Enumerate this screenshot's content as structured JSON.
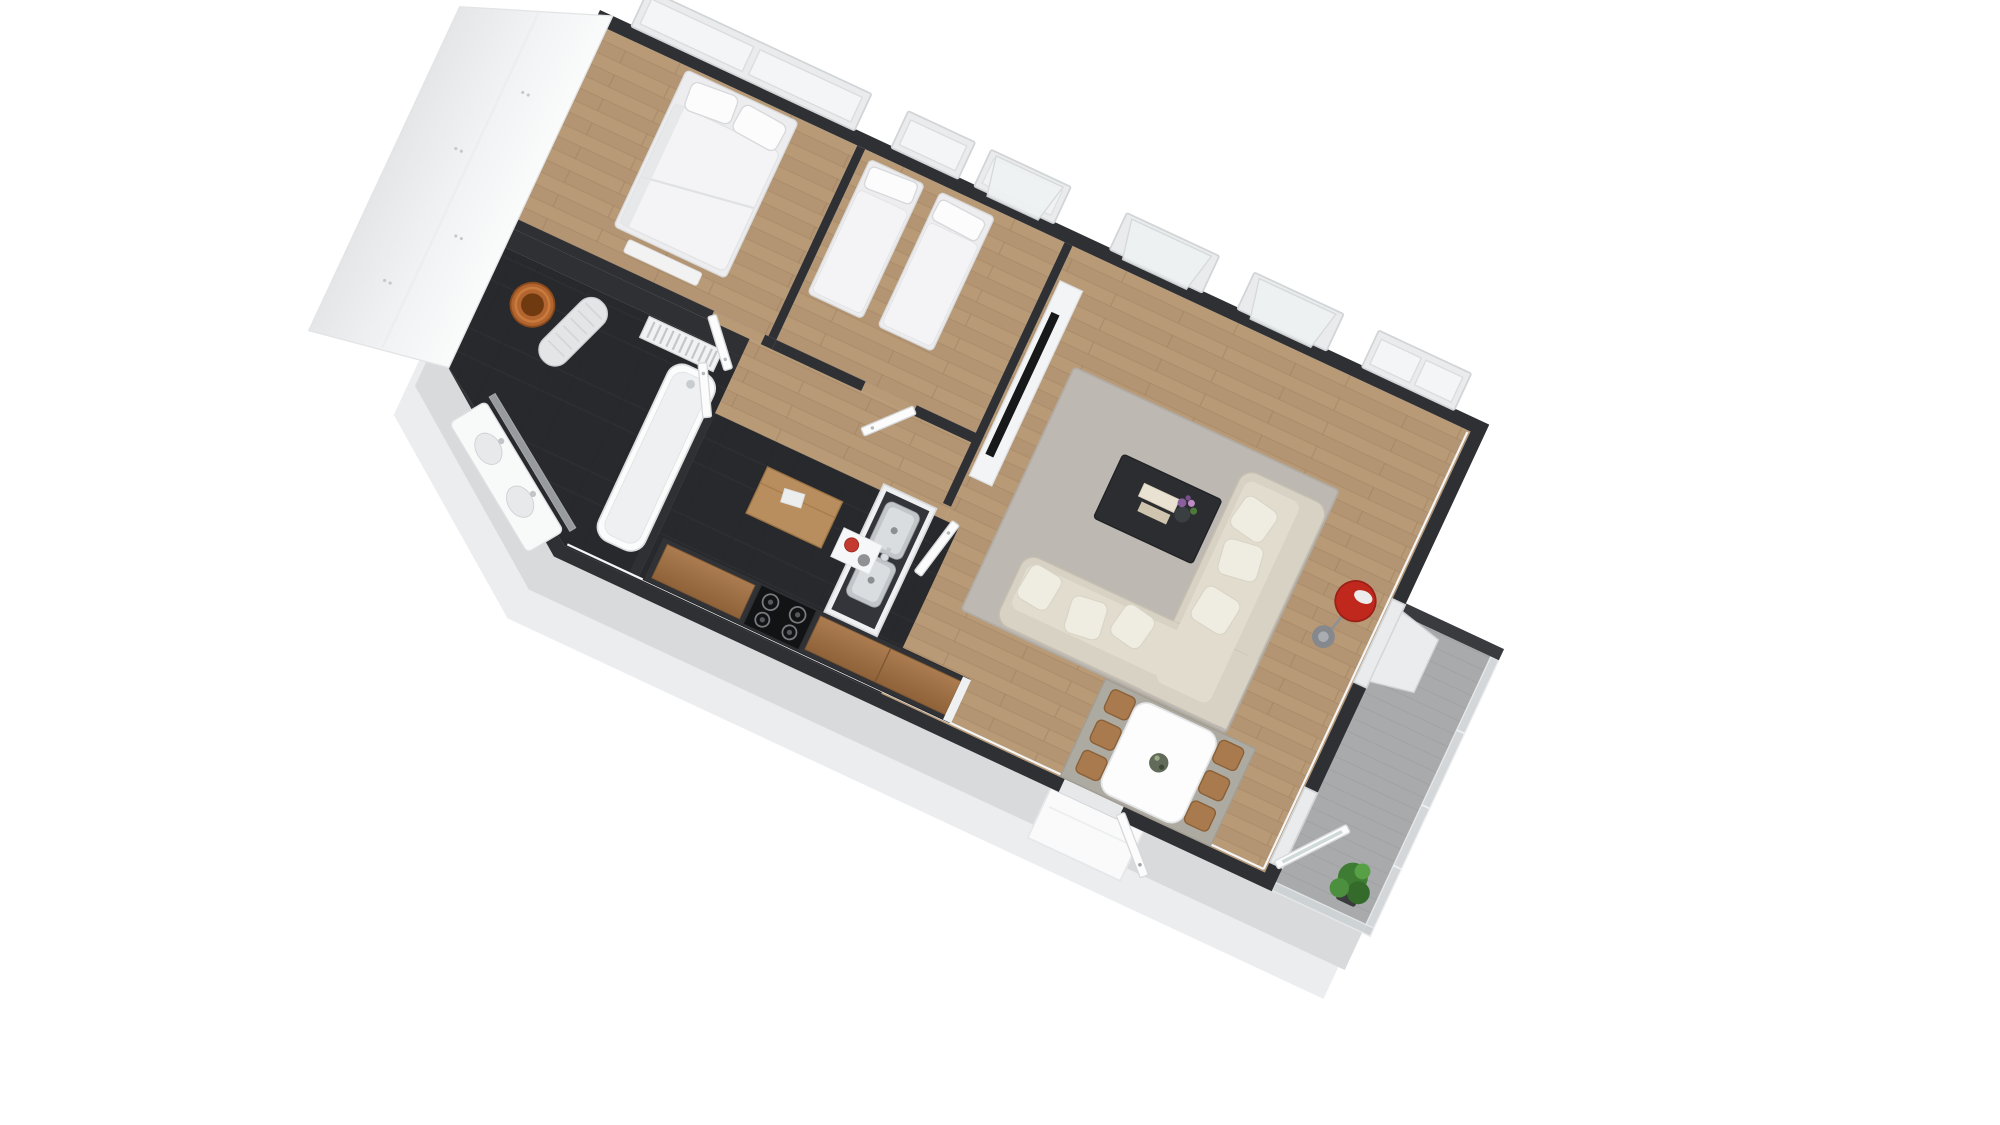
{
  "scene": {
    "title": "3D floor plan render of a two-bedroom apartment",
    "view": "rotated isometric top-down dollhouse view",
    "background": "#ffffff",
    "visible_text": ""
  },
  "palette": {
    "bg": "#ffffff",
    "wall": "#2f3033",
    "wallLight": "#3a3b3e",
    "shadow": "#d8dadc",
    "frame": "#d2d5d7",
    "glass": "#f3f5f6",
    "woodFloor": "#b89a77",
    "darkFloor": "#28292c",
    "cabinetWood": "#a4764c",
    "chairWood": "#a87a4e",
    "rugLiving": "#bdb9b2",
    "rugDining": "#acaaa1",
    "sofaBeige": "#d8d2c5",
    "lampRed": "#c0281d",
    "terracotta": "#b2652e",
    "steel": "#c2c6c9",
    "balconyFloor": "#a8aaac",
    "plantGreen": "#3f7c33"
  },
  "rooms": [
    {
      "id": "master-bedroom",
      "label": "Master bedroom",
      "floor": "wood",
      "furniture": [
        "double bed with two pillows",
        "foot bench",
        "wide two-pane window"
      ]
    },
    {
      "id": "second-bedroom",
      "label": "Second bedroom",
      "floor": "wood",
      "furniture": [
        "single bed",
        "single bed",
        "closed window",
        "tilt-open window"
      ]
    },
    {
      "id": "living-room",
      "label": "Living room",
      "floor": "wood",
      "furniture": [
        "TV lowboard with flat TV",
        "gray rug",
        "dark coffee table with books and flower vase",
        "beige corner sofa with six cushions",
        "red floor lamp",
        "dining table",
        "six wooden chairs",
        "dining rug",
        "three windows",
        "balcony door"
      ]
    },
    {
      "id": "kitchen",
      "label": "Kitchen",
      "floor": "dark",
      "furniture": [
        "counter run with wooden fronts",
        "four-burner cooktop",
        "double stainless sink peninsula",
        "shelf with red and gray pots"
      ]
    },
    {
      "id": "bathroom",
      "label": "Bathroom",
      "floor": "dark",
      "furniture": [
        "bathtub",
        "double washbasin vanity with glass screen",
        "towel radiator",
        "ironing board",
        "terracotta pot"
      ]
    },
    {
      "id": "hallway",
      "label": "Hallway",
      "floor": "wood",
      "furniture": [
        "wooden console",
        "four white interior doors"
      ]
    },
    {
      "id": "balcony",
      "label": "Balcony",
      "floor": "concrete",
      "furniture": [
        "glass railing",
        "green plant",
        "open balcony door"
      ]
    }
  ],
  "counts": {
    "double_beds": 1,
    "single_beds": 2,
    "windows_top_wall": 6,
    "windows_right_wall": 1,
    "dining_chairs": 6,
    "cooktop_burners": 4,
    "sink_bowls": 2,
    "interior_doors": 4,
    "entrance_doors": 1,
    "balcony_doors": 1
  }
}
